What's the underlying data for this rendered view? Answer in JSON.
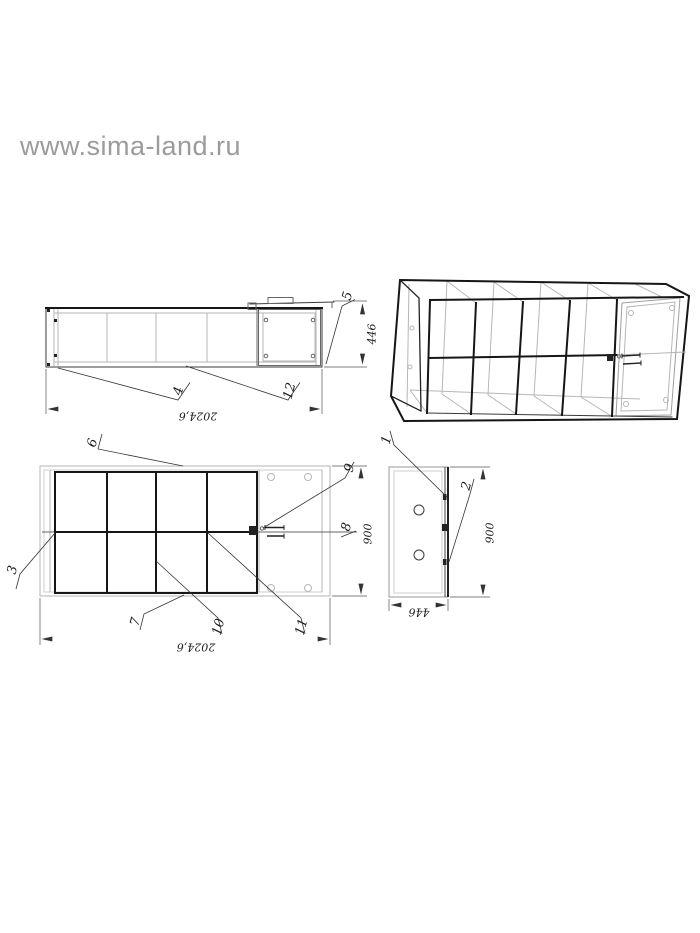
{
  "watermark": "www.sima-land.ru",
  "callouts": {
    "c1": "1",
    "c2": "2",
    "c3": "3",
    "c4": "4",
    "c5": "5",
    "c6": "6",
    "c7": "7",
    "c8": "8",
    "c9": "9",
    "c10": "10",
    "c11": "11",
    "c12": "12"
  },
  "dimensions": {
    "side_length": "2024,6",
    "side_height": "446",
    "plan_length": "2024,6",
    "plan_width": "900",
    "end_width": "446",
    "end_height": "900"
  },
  "colors": {
    "ink": "#1c1c1c",
    "hidden_line_gray": "#b6b6b6",
    "watermark_gray": "#9b9b9b",
    "background": "#ffffff"
  }
}
